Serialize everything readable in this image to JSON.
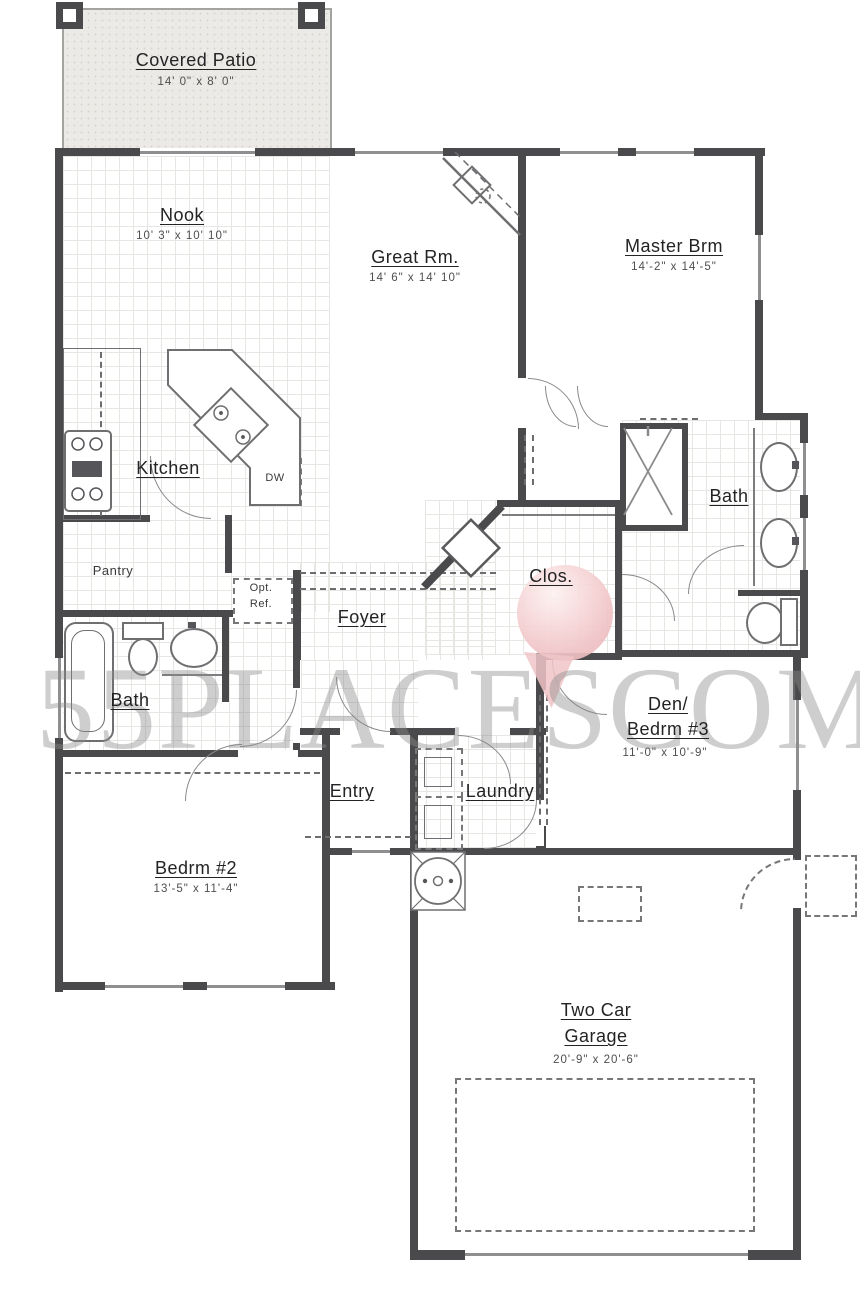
{
  "watermark": {
    "left_text": "55PLACES",
    "right_text": "COM"
  },
  "colors": {
    "wall": "#4a4a4c",
    "line": "#7d7d7f",
    "watermark_gray": "#8a8a8a",
    "pin_pink": "#efc2c5"
  },
  "rooms": {
    "covered_patio": {
      "name": "Covered Patio",
      "dims": "14' 0\" x 8' 0\""
    },
    "nook": {
      "name": "Nook",
      "dims": "10' 3\" x 10' 10\""
    },
    "great_room": {
      "name": "Great Rm.",
      "dims": "14' 6\" x 14' 10\""
    },
    "master": {
      "name": "Master Brm",
      "dims": "14'-2\" x 14'-5\""
    },
    "kitchen": {
      "name": "Kitchen"
    },
    "dishwasher": {
      "label": "DW"
    },
    "pantry": {
      "name": "Pantry"
    },
    "opt_ref": {
      "line1": "Opt.",
      "line2": "Ref."
    },
    "foyer": {
      "name": "Foyer"
    },
    "closet": {
      "name": "Clos."
    },
    "master_bath": {
      "name": "Bath"
    },
    "bath2": {
      "name": "Bath"
    },
    "den": {
      "name_line1": "Den/",
      "name_line2": "Bedrm #3",
      "dims": "11'-0\" x 10'-9\""
    },
    "entry": {
      "name": "Entry"
    },
    "laundry": {
      "name": "Laundry"
    },
    "bedroom2": {
      "name": "Bedrm #2",
      "dims": "13'-5\" x 11'-4\""
    },
    "garage": {
      "name_line1": "Two Car",
      "name_line2": "Garage",
      "dims": "20'-9\" x 20'-6\""
    }
  }
}
